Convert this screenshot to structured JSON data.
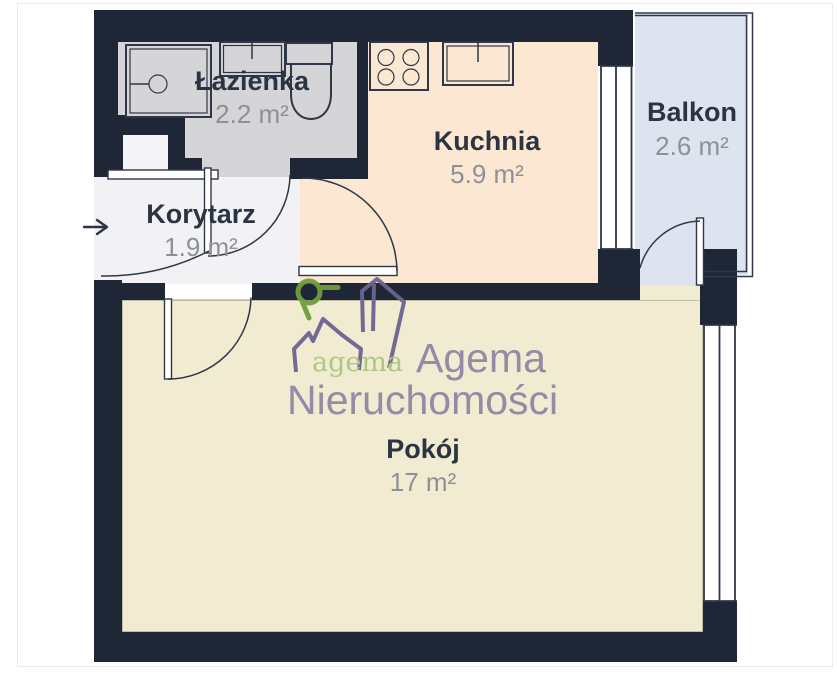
{
  "plan": {
    "rooms": {
      "lazienka": {
        "name": "Łazienka",
        "area": "2.2 m²"
      },
      "kuchnia": {
        "name": "Kuchnia",
        "area": "5.9 m²"
      },
      "korytarz": {
        "name": "Korytarz",
        "area": "1.9 m²"
      },
      "balkon": {
        "name": "Balkon",
        "area": "2.6 m²"
      },
      "pokoj": {
        "name": "Pokój",
        "area": "17 m²"
      }
    },
    "fixtures": [
      "shower",
      "washbasin",
      "toilet",
      "stove",
      "kitchen-sink",
      "wardrobe"
    ],
    "entrance_arrow": "→"
  },
  "watermark": {
    "logo_text": "agema",
    "line1": "Agema",
    "line2": "Nieruchomości"
  },
  "colors": {
    "wall": "#1f2737",
    "outline": "#2f3748",
    "bathroom_floor": "#d5d5d7",
    "corridor_floor": "#f2f2f4",
    "kitchen_floor": "#fbe7d2",
    "room_floor": "#f1ebd1",
    "balcony_floor": "#dde4ef",
    "label": "#2b3443",
    "area_label": "#8f9097",
    "watermark_purple": "#8d87a5",
    "watermark_purple_stroke": "#6c6492",
    "watermark_green_text": "#a9c87d",
    "watermark_green_icon": "#6f9e3d"
  }
}
